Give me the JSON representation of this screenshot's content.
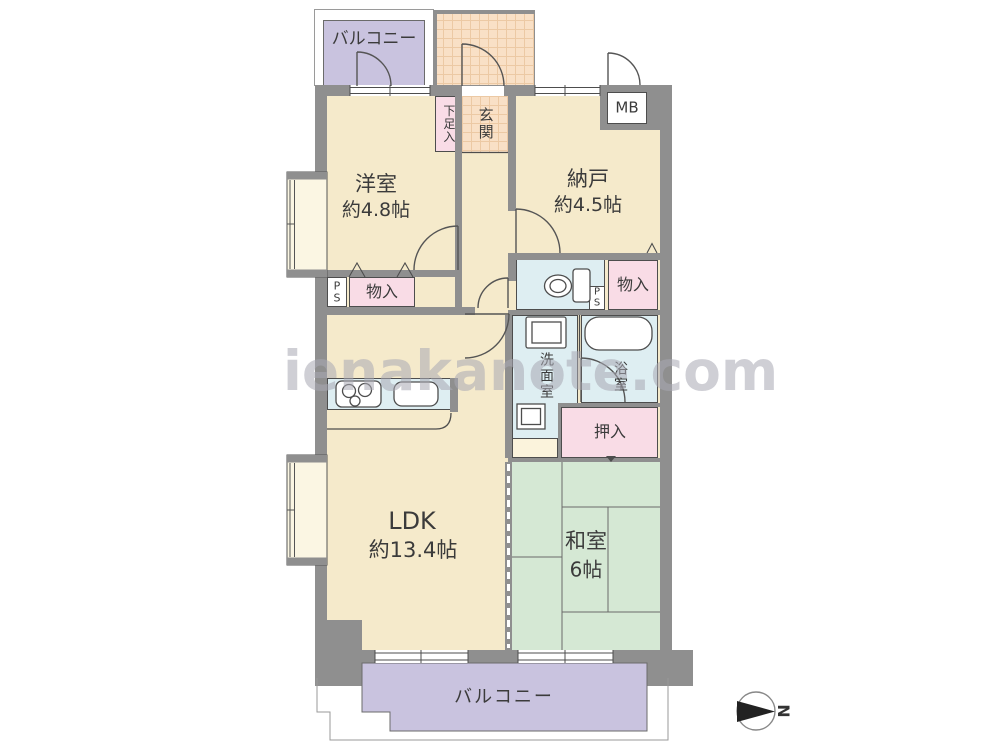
{
  "watermark": {
    "text": "ienakanote.com"
  },
  "compass": {
    "north": "N"
  },
  "balcony_top": {
    "label": "バルコニー"
  },
  "balcony_bottom": {
    "label": "バルコニー"
  },
  "entrance": {
    "room": "玄関",
    "shoe_cabinet": "下足入",
    "meter_box": "MB"
  },
  "rooms": {
    "western": {
      "name": "洋室",
      "size": "約4.8帖"
    },
    "storage": {
      "name": "納戸",
      "size": "約4.5帖"
    },
    "ldk": {
      "name": "LDK",
      "size": "約13.4帖"
    },
    "tatami": {
      "name": "和室",
      "size": "6帖"
    }
  },
  "storage_units": {
    "closet_left": "物入",
    "closet_right": "物入",
    "futon_closet": "押入",
    "pipe_space_left": "PS",
    "pipe_space_right": "PS"
  },
  "wet": {
    "washroom": "洗面室",
    "bathroom": "浴室"
  },
  "colors": {
    "wall_gray": "#8F8F8F",
    "room_cream": "#F5EACB",
    "bay_cream": "#FBF6E3",
    "tatami_green": "#D5E8D4",
    "water_blue": "#DEEEF2",
    "closet_pink": "#F9DCE6",
    "balcony_purple": "#C9C3DF",
    "entrance_tile": "#F9E0C6",
    "line_dark": "#4d4d4d"
  }
}
